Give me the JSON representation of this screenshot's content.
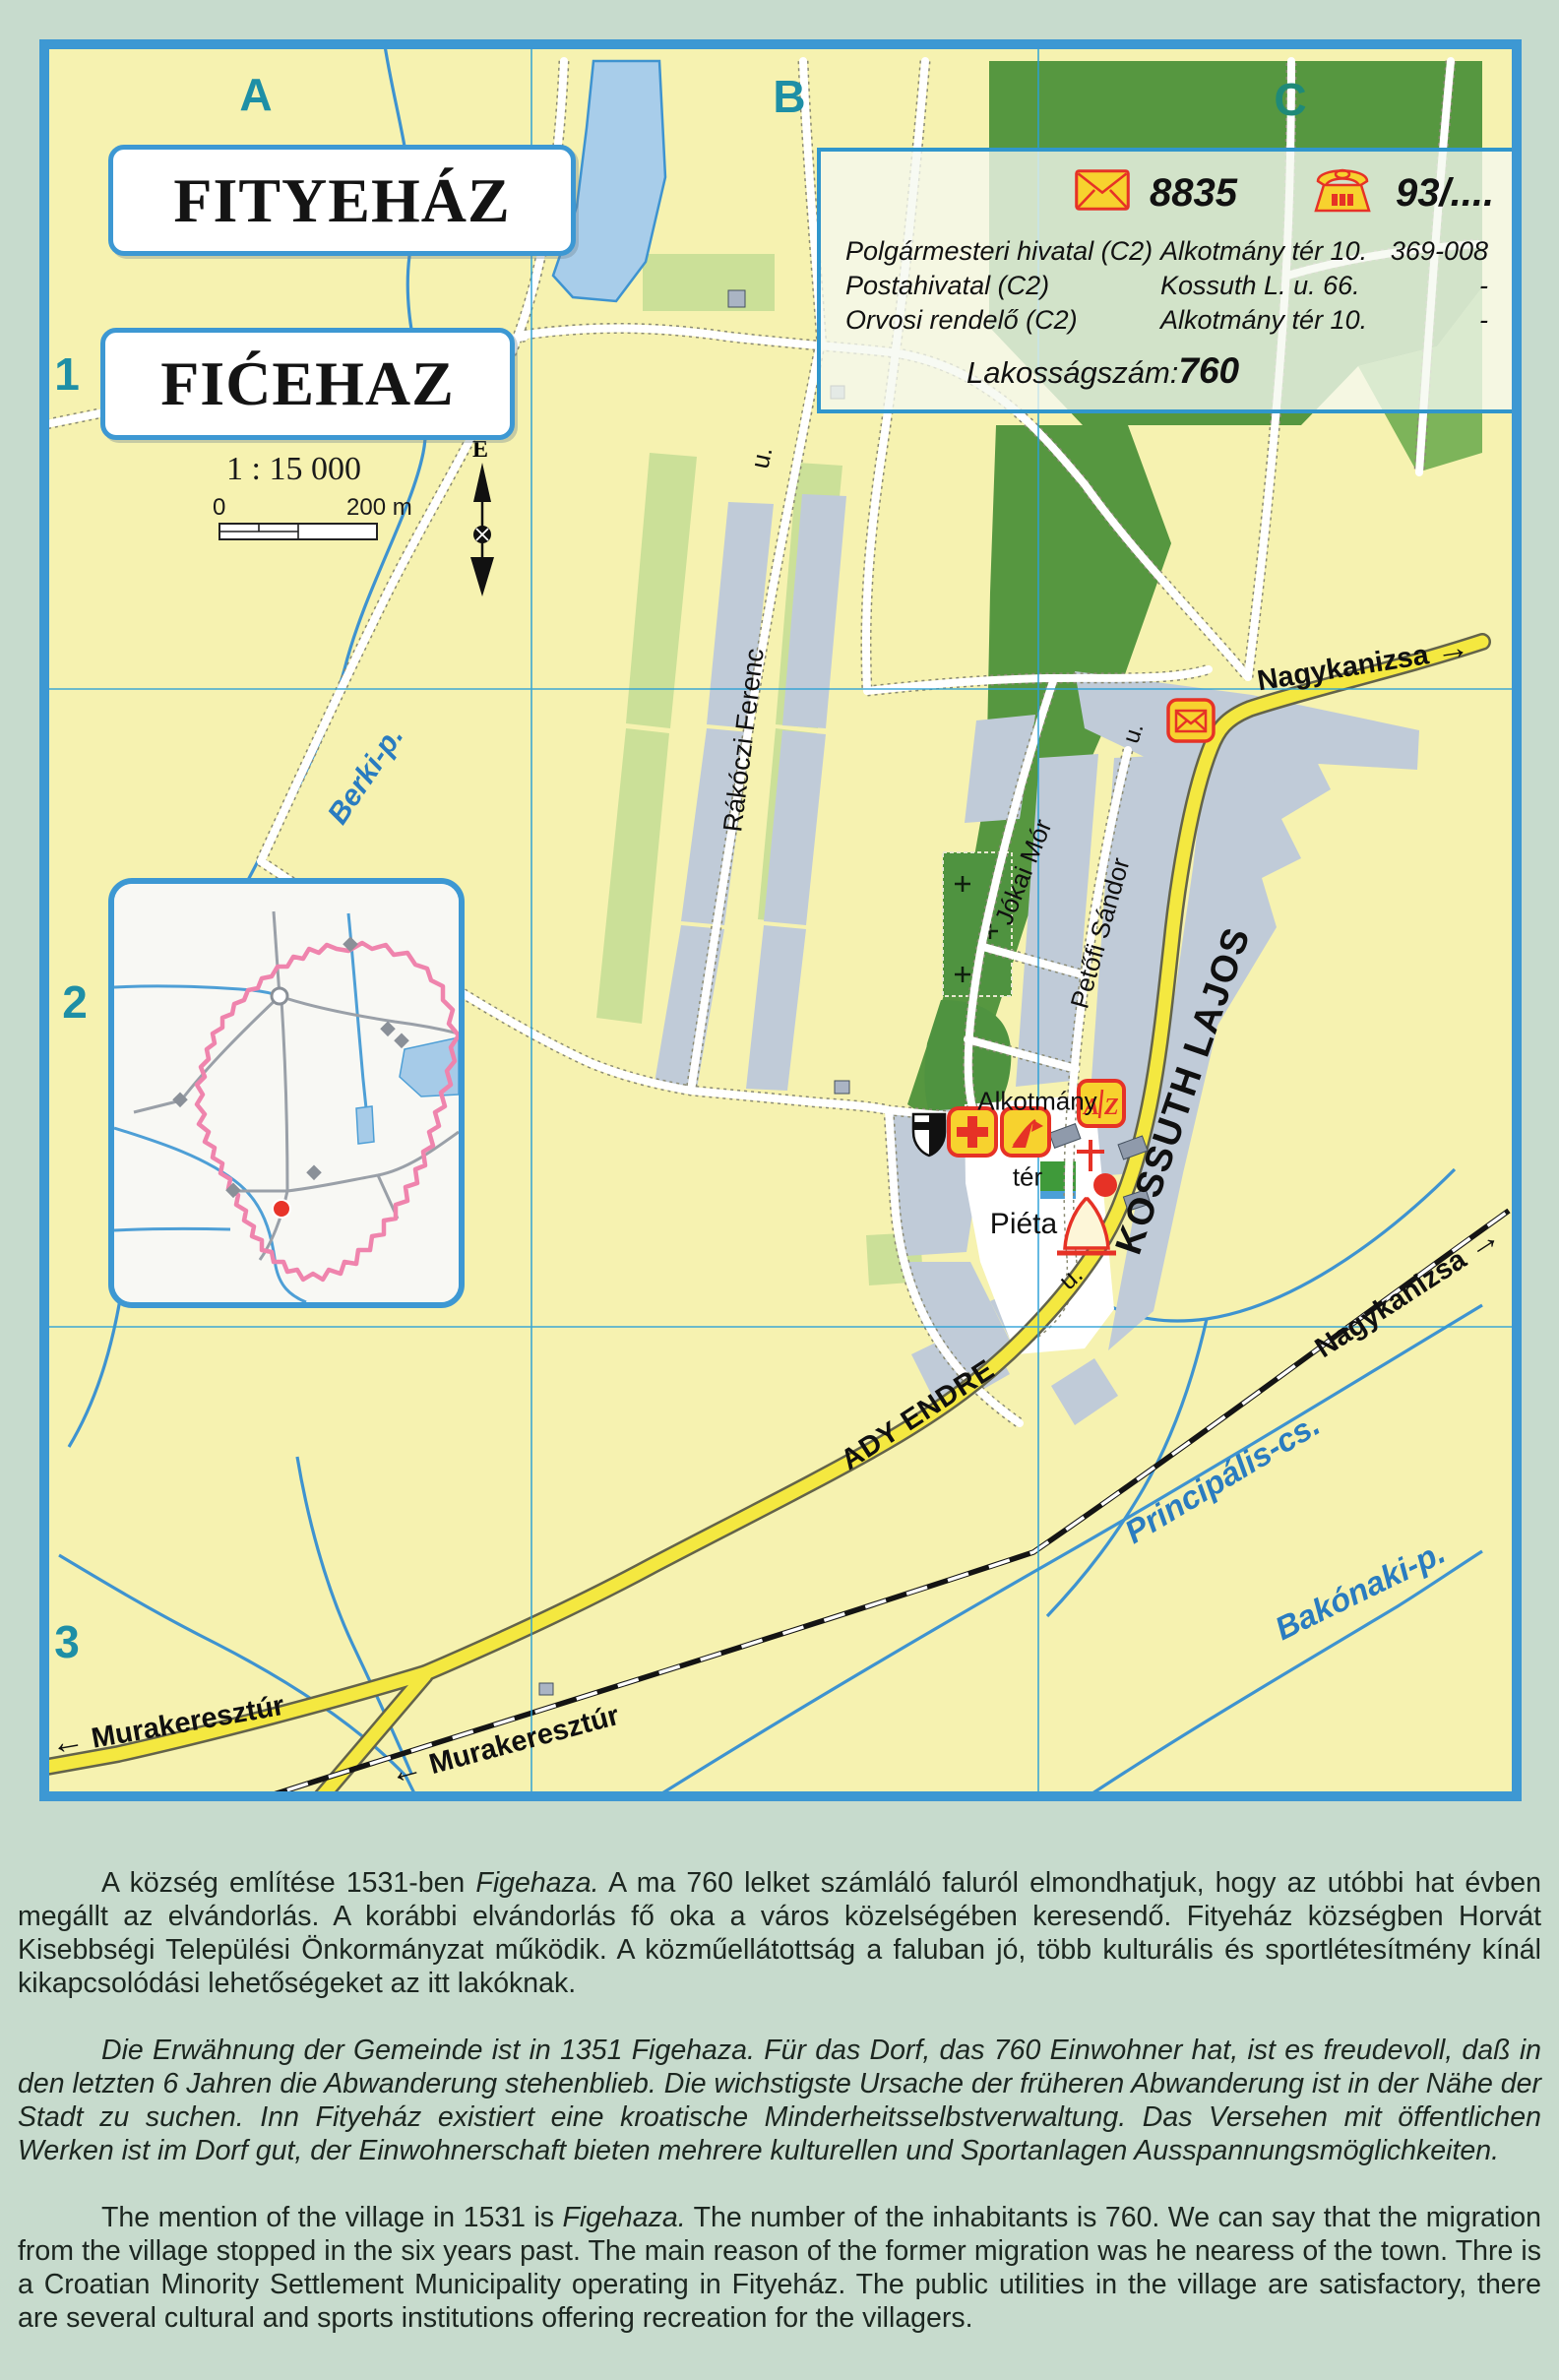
{
  "map": {
    "grid": {
      "col_a": "A",
      "col_b": "B",
      "col_c": "C",
      "row_1": "1",
      "row_2": "2",
      "row_3": "3"
    },
    "titles": {
      "hungarian": "FITYEHÁZ",
      "croatian": "FIĆEHAZ"
    },
    "scale": {
      "ratio": "1 : 15 000",
      "zero": "0",
      "end": "200 m",
      "north": "É"
    },
    "infobox": {
      "postal_code": "8835",
      "phone_prefix": "93/....",
      "rows": [
        {
          "name": "Polgármesteri hivatal (C2)",
          "address": "Alkotmány tér 10.",
          "phone": "369-008"
        },
        {
          "name": "Postahivatal (C2)",
          "address": "Kossuth L. u. 66.",
          "phone": "-"
        },
        {
          "name": "Orvosi rendelő (C2)",
          "address": "Alkotmány tér 10.",
          "phone": "-"
        }
      ],
      "population_label": "Lakosságszám:",
      "population_value": "760"
    },
    "labels": {
      "rakoczi": "Rákóczi Ferenc",
      "u": "u.",
      "jokai": "Jókai Mór",
      "petofi": "Petőfi Sándor",
      "kossuth": "KOSSUTH LAJOS",
      "ady": "ADY ENDRE",
      "alkotmany": "Alkotmány",
      "ter": "tér",
      "pieta": "Piéta",
      "nagykanizsa": "Nagykanizsa",
      "murakeresztur": "Murakeresztúr",
      "berki": "Berki-p.",
      "principalis": "Principális-cs.",
      "bakonaki": "Bakónaki-p.",
      "az_a": "A",
      "az_z": "Z"
    },
    "icons": {
      "arrow_right": "→",
      "arrow_left": "←"
    },
    "colors": {
      "accent_blue": "#3d98d3",
      "road_yellow": "#f4e840",
      "water_blue": "#3e93d0",
      "icon_red": "#e63226",
      "icon_yellow": "#f7d22e",
      "boundary_pink": "#ef84ad"
    }
  },
  "paragraphs": {
    "hu_prefix": "A község említése 1531-ben ",
    "hu_italic": "Figehaza.",
    "hu_rest": " A ma 760 lelket számláló faluról elmondhatjuk, hogy az utóbbi hat évben megállt az elvándorlás. A korábbi elvándorlás fő oka a város közelségében keresendő. Fityeház községben Horvát Kisebbségi Települési Önkormányzat működik. A közműellátottság a faluban jó, több kulturális és sportlétesítmény kínál kikapcsolódási lehetőségeket az itt lakóknak.",
    "de": "Die Erwähnung der Gemeinde ist in 1351 Figehaza.  Für das Dorf, das 760 Einwohner hat, ist es freudevoll, daß in den letzten 6 Jahren die Abwanderung stehenblieb. Die wichstigste Ursache der früheren Abwanderung ist in der Nähe der Stadt zu suchen. Inn Fityeház existiert eine kroatische Minderheitsselbstverwaltung. Das Versehen mit öffentlichen Werken ist im Dorf gut, der Einwohnerschaft bieten mehrere kulturellen und Sportanlagen Ausspannungsmöglichkeiten.",
    "en_prefix": "The mention of the village in 1531 is ",
    "en_italic": "Figehaza.",
    "en_rest": " The number of the inhabitants is 760. We can say that the migration from the village stopped in the six years past. The main reason of the former migration was he nearess of the town. Thre is a Croatian Minority Settlement Municipality operating in Fityeház. The public utilities in the village are satisfactory, there are several cultural and sports institutions offering recreation for the villagers."
  }
}
